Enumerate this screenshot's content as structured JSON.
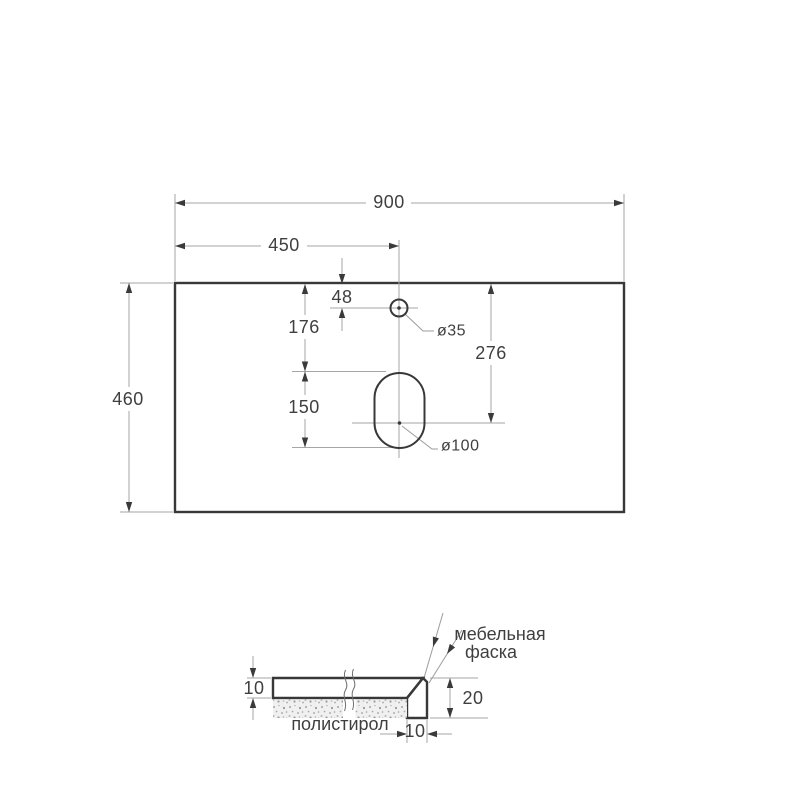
{
  "drawing": {
    "kind": "countertop technical drawing",
    "colors": {
      "outline": "#383838",
      "dimension_line": "#a6a6a6",
      "text": "#3f3f3f",
      "hatch": "#8f8f8f",
      "background": "#ffffff"
    },
    "top_view": {
      "dims": {
        "overall_width": "900",
        "center_offset": "450",
        "overall_depth": "460",
        "faucet_hole_from_edge": "48",
        "slot_top_from_edge": "176",
        "slot_length": "150",
        "slot_center_from_edge": "276",
        "faucet_hole_diameter": "ø35",
        "drain_slot_diameter": "ø100"
      }
    },
    "section_view": {
      "dims": {
        "slab_thickness": "10",
        "edge_height": "20",
        "edge_width": "10"
      },
      "labels": {
        "chamfer_line1": "мебельная",
        "chamfer_line2": "фаска",
        "filler": "полистирол"
      }
    }
  }
}
